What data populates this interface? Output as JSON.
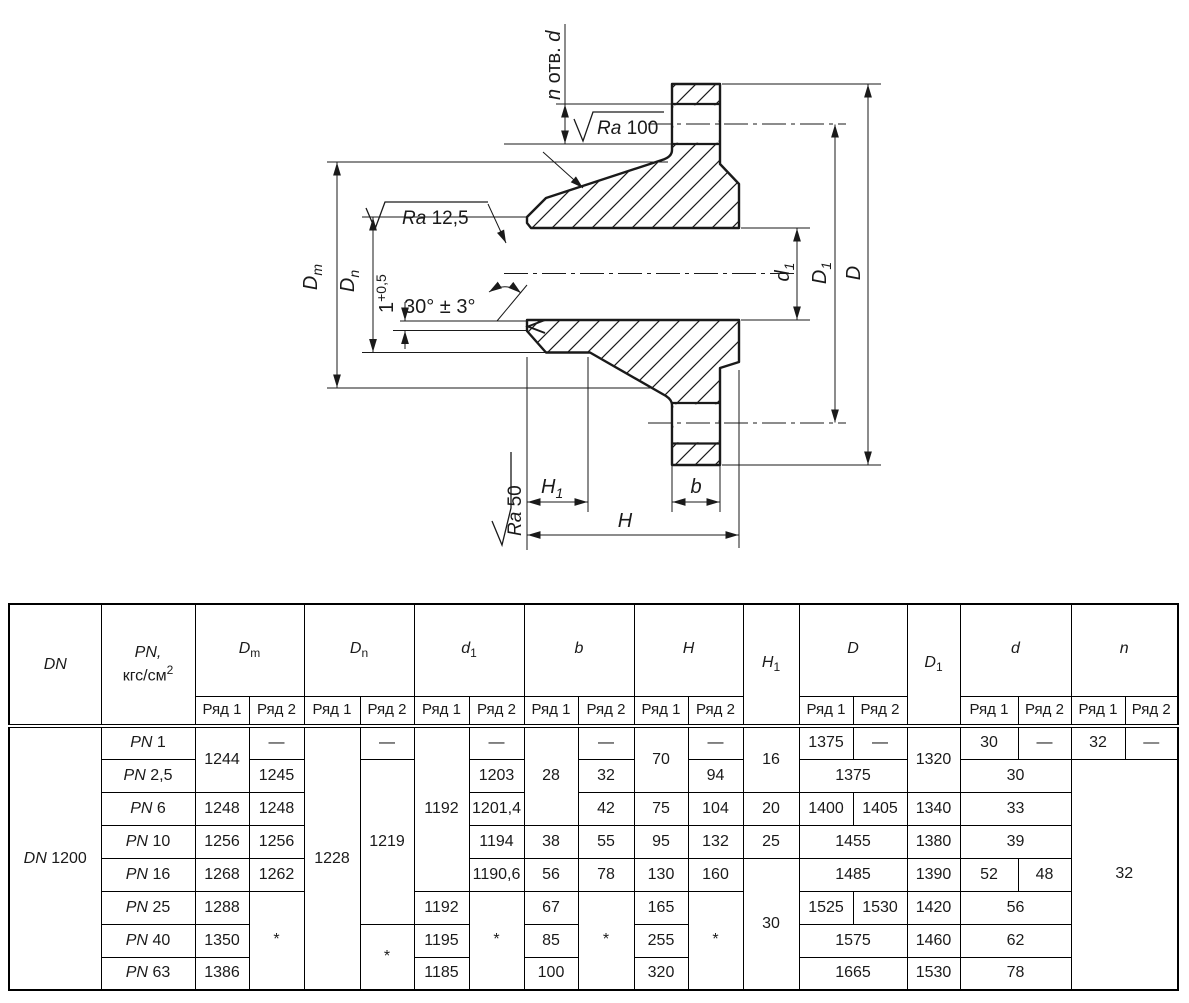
{
  "page": {
    "background": "#ffffff",
    "ink": "#000000"
  },
  "drawing": {
    "labels": {
      "n_holes": {
        "pre": "n",
        "mid": " отв. ",
        "post": "d"
      },
      "ra_top": {
        "sym": "Ra",
        "val": " 100"
      },
      "ra_mid": {
        "sym": "Ra",
        "val": " 12,5"
      },
      "ra_bottom": {
        "sym": "Ra",
        "val": " 50"
      },
      "angle": "30° ± 3°",
      "depth": {
        "base": "1",
        "sup": "+0,5"
      },
      "dm": {
        "b": "D",
        "s": "m"
      },
      "dn": {
        "b": "D",
        "s": "n"
      },
      "d1s": {
        "b": "d",
        "s": "1"
      },
      "d1b": {
        "b": "D",
        "s": "1"
      },
      "dbig": "D",
      "h": "H",
      "h1": {
        "b": "H",
        "s": "1"
      },
      "b": "b"
    }
  },
  "table": {
    "dn": {
      "p": "DN",
      "n": "1200"
    },
    "pn_prefix": "PN",
    "pn": [
      "1",
      "2,5",
      "6",
      "10",
      "16",
      "25",
      "40",
      "63"
    ],
    "columns": {
      "dn": "DN",
      "pn": {
        "l1": "PN,",
        "l2": "кгс/см",
        "sup": "2"
      },
      "row1": "Ряд 1",
      "row2": "Ряд 2",
      "groups": [
        {
          "b": "D",
          "s": "m"
        },
        {
          "b": "D",
          "s": "n"
        },
        {
          "b": "d",
          "s": "1"
        },
        {
          "b": "b"
        },
        {
          "b": "H"
        },
        {
          "b": "D"
        },
        {
          "b": "d"
        },
        {
          "b": "n"
        }
      ],
      "h1": {
        "b": "H",
        "s": "1"
      },
      "d1": {
        "b": "D",
        "s": "1"
      }
    },
    "body": [
      [
        "1244",
        "—",
        "1228",
        "—",
        "1192",
        "—",
        "28",
        "—",
        "70",
        "—",
        "16",
        "1375",
        "—",
        "1320",
        "30",
        "—",
        "32",
        "—"
      ],
      [
        "1245",
        "1219",
        "1203",
        "32",
        "94",
        "1375",
        "30",
        "32"
      ],
      [
        "1248",
        "1248",
        "1201,4",
        "42",
        "75",
        "104",
        "20",
        "1400",
        "1405",
        "1340",
        "33"
      ],
      [
        "1256",
        "1256",
        "1194",
        "38",
        "55",
        "95",
        "132",
        "25",
        "1455",
        "1380",
        "39"
      ],
      [
        "1268",
        "1262",
        "1190,6",
        "56",
        "78",
        "130",
        "160",
        "30",
        "1485",
        "1390",
        "52",
        "48"
      ],
      [
        "1288",
        "*",
        "1192",
        "*",
        "67",
        "*",
        "165",
        "*",
        "1525",
        "1530",
        "1420",
        "56"
      ],
      [
        "1350",
        "*",
        "1195",
        "85",
        "255",
        "1575",
        "1460",
        "62"
      ],
      [
        "1386",
        "1185",
        "100",
        "320",
        "1665",
        "1530",
        "78"
      ]
    ]
  }
}
